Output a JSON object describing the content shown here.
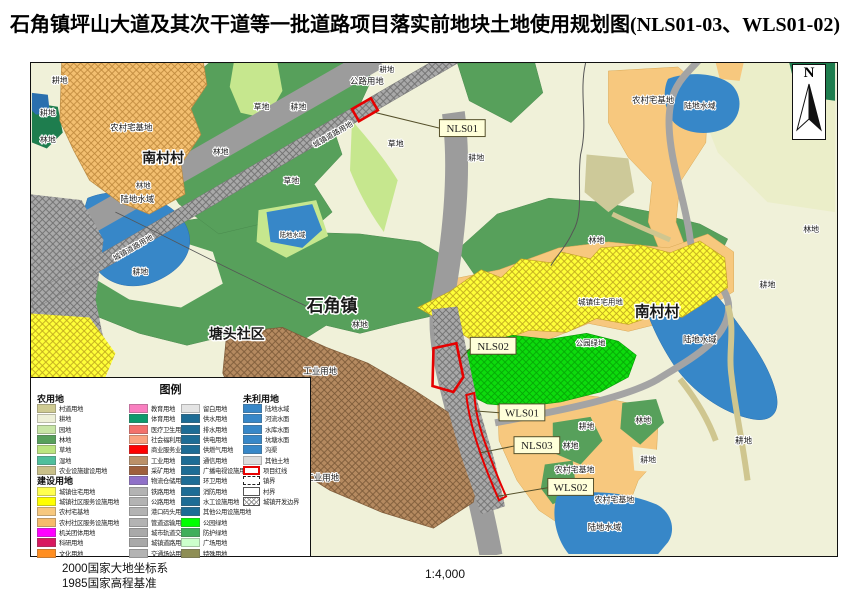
{
  "title": "石角镇坪山大道及其次干道等一批道路项目落实前地块土地使用规划图(NLS01-03、WLS01-02)",
  "north": {
    "label": "N"
  },
  "footer": {
    "line1": "2000国家大地坐标系",
    "line2": "1985国家高程基准",
    "scale": "1:4,000"
  },
  "legend": {
    "title": "图例",
    "col1": [
      {
        "h": "农用地"
      },
      {
        "c": "#cfcb92",
        "t": "村道用地"
      },
      {
        "c": "#eef0d8",
        "t": "耕地"
      },
      {
        "c": "#c8e6a6",
        "t": "园地"
      },
      {
        "c": "#57a05b",
        "t": "林地"
      },
      {
        "c": "#bce57f",
        "t": "草地"
      },
      {
        "c": "#4fbf9c",
        "t": "湿地"
      },
      {
        "c": "#c9c089",
        "t": "农业设施建设用地"
      },
      {
        "h": "建设用地"
      },
      {
        "c": "#ffff4f",
        "t": "城镇住宅用地"
      },
      {
        "c": "#ffff00",
        "t": "城镇社区服务设施用地"
      },
      {
        "c": "#f7c87e",
        "t": "农村宅基地"
      },
      {
        "c": "#f6bb6b",
        "t": "农村社区服务设施用地"
      },
      {
        "c": "#ff00ff",
        "t": "机关团体用地"
      },
      {
        "c": "#d8185f",
        "t": "科研用地"
      },
      {
        "c": "#ff8e21",
        "t": "文化用地"
      }
    ],
    "col2": [
      {
        "c": "#f97fc0",
        "t": "教育用地"
      },
      {
        "c": "#0c9a6c",
        "t": "体育用地"
      },
      {
        "c": "#f3716c",
        "t": "医疗卫生用地"
      },
      {
        "c": "#f9a380",
        "t": "社会福利用地"
      },
      {
        "c": "#fe0000",
        "t": "商业服务业用地"
      },
      {
        "c": "#bb9068",
        "t": "工业用地"
      },
      {
        "c": "#9e5f3c",
        "t": "采矿用地"
      },
      {
        "c": "#8f70c8",
        "t": "物流仓储用地"
      },
      {
        "c": "#b3b3b3",
        "t": "铁路用地"
      },
      {
        "c": "#b3b3b3",
        "t": "公路用地"
      },
      {
        "c": "#b3b3b3",
        "t": "港口码头用地"
      },
      {
        "c": "#b3b3b3",
        "t": "管道运输用地"
      },
      {
        "c": "#a9a9a9",
        "t": "城市轨道交通用地"
      },
      {
        "c": "#a9a9a9",
        "t": "城镇道路用地"
      },
      {
        "c": "#b3b3b3",
        "t": "交通场站用地"
      }
    ],
    "col3": [
      {
        "c": "#e4e4e4",
        "t": "留白用地"
      },
      {
        "c": "#1d6c95",
        "t": "供水用地"
      },
      {
        "c": "#1d6c95",
        "t": "排水用地"
      },
      {
        "c": "#1d6c95",
        "t": "供电用地"
      },
      {
        "c": "#1d6c95",
        "t": "供燃气用地"
      },
      {
        "c": "#1d6c95",
        "t": "通信用地"
      },
      {
        "c": "#1d6c95",
        "t": "广播电视设施用地"
      },
      {
        "c": "#1d6c95",
        "t": "环卫用地"
      },
      {
        "c": "#1d6c95",
        "t": "消防用地"
      },
      {
        "c": "#1d6c95",
        "t": "水工设施用地"
      },
      {
        "c": "#1d6c95",
        "t": "其他公用设施用地"
      },
      {
        "c": "#00ff00",
        "t": "公园绿地"
      },
      {
        "c": "#3fae5a",
        "t": "防护绿地"
      },
      {
        "c": "#ccffcc",
        "t": "广场用地"
      },
      {
        "c": "#8e8e55",
        "t": "特殊用地"
      }
    ],
    "col4": [
      {
        "h": "未利用地"
      },
      {
        "c": "#3787c8",
        "t": "陆地水域"
      },
      {
        "c": "#3787c8",
        "t": "河流水面"
      },
      {
        "c": "#3787c8",
        "t": "水库水面"
      },
      {
        "c": "#3787c8",
        "t": "坑塘水面"
      },
      {
        "c": "#3787c8",
        "t": "沟渠"
      },
      {
        "c": "#dcdcdc",
        "t": "其他土地"
      },
      {
        "sym": "red",
        "t": "项目红线"
      },
      {
        "sym": "dash",
        "t": "镇界"
      },
      {
        "sym": "solid",
        "t": "村界"
      },
      {
        "sym": "hatch",
        "t": "城镇开发边界"
      }
    ]
  },
  "map": {
    "labels": [
      {
        "t": "耕地",
        "x": 28,
        "y": 20,
        "s": 8
      },
      {
        "t": "耕地",
        "x": 16,
        "y": 53,
        "s": 8
      },
      {
        "t": "林地",
        "x": 16,
        "y": 80,
        "s": 8
      },
      {
        "t": "农村宅基地",
        "x": 100,
        "y": 68,
        "s": 8.5
      },
      {
        "t": "南村村",
        "x": 132,
        "y": 100,
        "s": 14,
        "b": 1
      },
      {
        "t": "林地",
        "x": 190,
        "y": 92,
        "s": 8
      },
      {
        "t": "草地",
        "x": 231,
        "y": 47,
        "s": 8
      },
      {
        "t": "耕地",
        "x": 268,
        "y": 47,
        "s": 8
      },
      {
        "t": "公路用地",
        "x": 337,
        "y": 21,
        "s": 8.5
      },
      {
        "t": "耕地",
        "x": 357,
        "y": 9,
        "s": 7.5
      },
      {
        "t": "草地",
        "x": 366,
        "y": 84,
        "s": 8
      },
      {
        "t": "城镇道路用地",
        "x": 304,
        "y": 74,
        "s": 7.5,
        "r": -30
      },
      {
        "t": "城镇道路用地",
        "x": 103,
        "y": 188,
        "s": 7.5,
        "r": -30
      },
      {
        "t": "耕地",
        "x": 447,
        "y": 98,
        "s": 8
      },
      {
        "t": "陆地水域",
        "x": 672,
        "y": 46,
        "s": 8
      },
      {
        "t": "农村宅基地",
        "x": 625,
        "y": 40,
        "s": 8.5
      },
      {
        "t": "林地",
        "x": 784,
        "y": 170,
        "s": 8
      },
      {
        "t": "耕地",
        "x": 740,
        "y": 226,
        "s": 8
      },
      {
        "t": "陆地水域",
        "x": 106,
        "y": 140,
        "s": 8.5
      },
      {
        "t": "林地",
        "x": 112,
        "y": 126,
        "s": 7.5
      },
      {
        "t": "草地",
        "x": 261,
        "y": 121,
        "s": 8
      },
      {
        "t": "陆地水域",
        "x": 262,
        "y": 175,
        "s": 6.5
      },
      {
        "t": "耕地",
        "x": 109,
        "y": 213,
        "s": 8
      },
      {
        "t": "石角镇",
        "x": 302,
        "y": 250,
        "s": 17,
        "b": 1
      },
      {
        "t": "林地",
        "x": 330,
        "y": 266,
        "s": 8
      },
      {
        "t": "塘头社区",
        "x": 206,
        "y": 277,
        "s": 14,
        "b": 1
      },
      {
        "t": "工业用地",
        "x": 290,
        "y": 313,
        "s": 8.5
      },
      {
        "t": "工业用地",
        "x": 292,
        "y": 420,
        "s": 8.5
      },
      {
        "t": "林地",
        "x": 568,
        "y": 181,
        "s": 8
      },
      {
        "t": "城镇住宅用地",
        "x": 572,
        "y": 243,
        "s": 7.5
      },
      {
        "t": "南村村",
        "x": 629,
        "y": 255,
        "s": 15,
        "b": 1
      },
      {
        "t": "公园绿地",
        "x": 562,
        "y": 284,
        "s": 7.5
      },
      {
        "t": "陆地水域",
        "x": 672,
        "y": 281,
        "s": 8.5
      },
      {
        "t": "耕地",
        "x": 558,
        "y": 368,
        "s": 8
      },
      {
        "t": "林地",
        "x": 542,
        "y": 388,
        "s": 8
      },
      {
        "t": "林地",
        "x": 615,
        "y": 362,
        "s": 8
      },
      {
        "t": "耕地",
        "x": 620,
        "y": 402,
        "s": 8
      },
      {
        "t": "农村宅基地",
        "x": 546,
        "y": 412,
        "s": 8
      },
      {
        "t": "农村宅基地",
        "x": 586,
        "y": 442,
        "s": 8
      },
      {
        "t": "陆地水域",
        "x": 576,
        "y": 470,
        "s": 8.5
      },
      {
        "t": "耕地",
        "x": 716,
        "y": 383,
        "s": 8.5
      }
    ],
    "plots": [
      {
        "id": "NLS01",
        "bx": 410,
        "by": 57,
        "lx": 346,
        "ly": 50
      },
      {
        "id": "NLS02",
        "bx": 441,
        "by": 276,
        "lx": 431,
        "ly": 298
      },
      {
        "id": "WLS01",
        "bx": 470,
        "by": 343,
        "lx": 445,
        "ly": 350
      },
      {
        "id": "NLS03",
        "bx": 485,
        "by": 376,
        "lx": 452,
        "ly": 392
      },
      {
        "id": "WLS02",
        "bx": 519,
        "by": 418,
        "lx": 468,
        "ly": 436
      }
    ]
  }
}
